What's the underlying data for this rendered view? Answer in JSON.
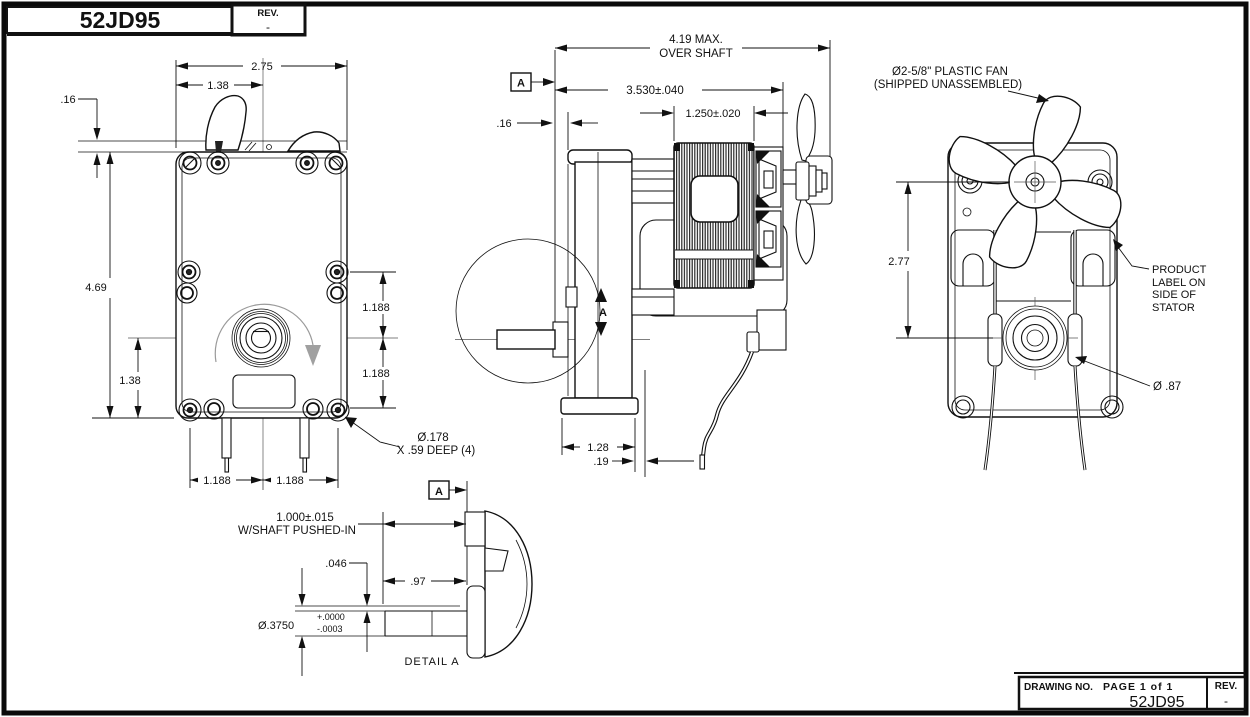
{
  "sheet": {
    "top_block": {
      "part_no": "52JD95",
      "rev_label": "REV.",
      "rev_value": "-"
    },
    "bottom_block": {
      "drawing_no_label": "DRAWING NO.",
      "page": "PAGE 1 of 1",
      "drawing_no": "52JD95",
      "rev_label": "REV.",
      "rev_value": "-"
    }
  },
  "front_view": {
    "dim_overall_width": "2.75",
    "dim_half_width": "1.38",
    "dim_plate_offset": ".16",
    "dim_overall_height": "4.69",
    "dim_shaft_to_base": "1.38",
    "dim_upper_hole_to_center": "1.188",
    "dim_center_to_lower_hole": "1.188",
    "dim_hole_left": "1.188",
    "dim_hole_right": "1.188",
    "hole_callout_1": "Ø.178",
    "hole_callout_2": "X .59 DEEP (4)"
  },
  "side_view": {
    "datum_flag": "A",
    "dim_max_length_1": "4.19 MAX.",
    "dim_max_length_2": "OVER SHAFT",
    "dim_body_length": "3.530±.040",
    "dim_stator_width": "1.250±.020",
    "dim_face_gap": ".16",
    "dim_base_depth": "1.28",
    "dim_terminal_offset": ".19",
    "section_marker": "A"
  },
  "rear_view": {
    "fan_callout_1": "Ø2-5/8\" PLASTIC FAN",
    "fan_callout_2": "(SHIPPED UNASSEMBLED)",
    "dim_fan_to_shaft": "2.77",
    "product_label_1": "PRODUCT",
    "product_label_2": "LABEL ON",
    "product_label_3": "SIDE OF",
    "product_label_4": "STATOR",
    "dim_boss_dia": "Ø .87"
  },
  "detail_a": {
    "datum_flag": "A",
    "dim_pushed_in_1": "1.000±.015",
    "dim_pushed_in_2": "W/SHAFT PUSHED-IN",
    "dim_flat_depth": ".046",
    "dim_shaft_length": ".97",
    "dim_shaft_dia": "Ø.3750",
    "dim_shaft_dia_tol_plus": "+.0000",
    "dim_shaft_dia_tol_minus": "-.0003",
    "title": "DETAIL A"
  }
}
